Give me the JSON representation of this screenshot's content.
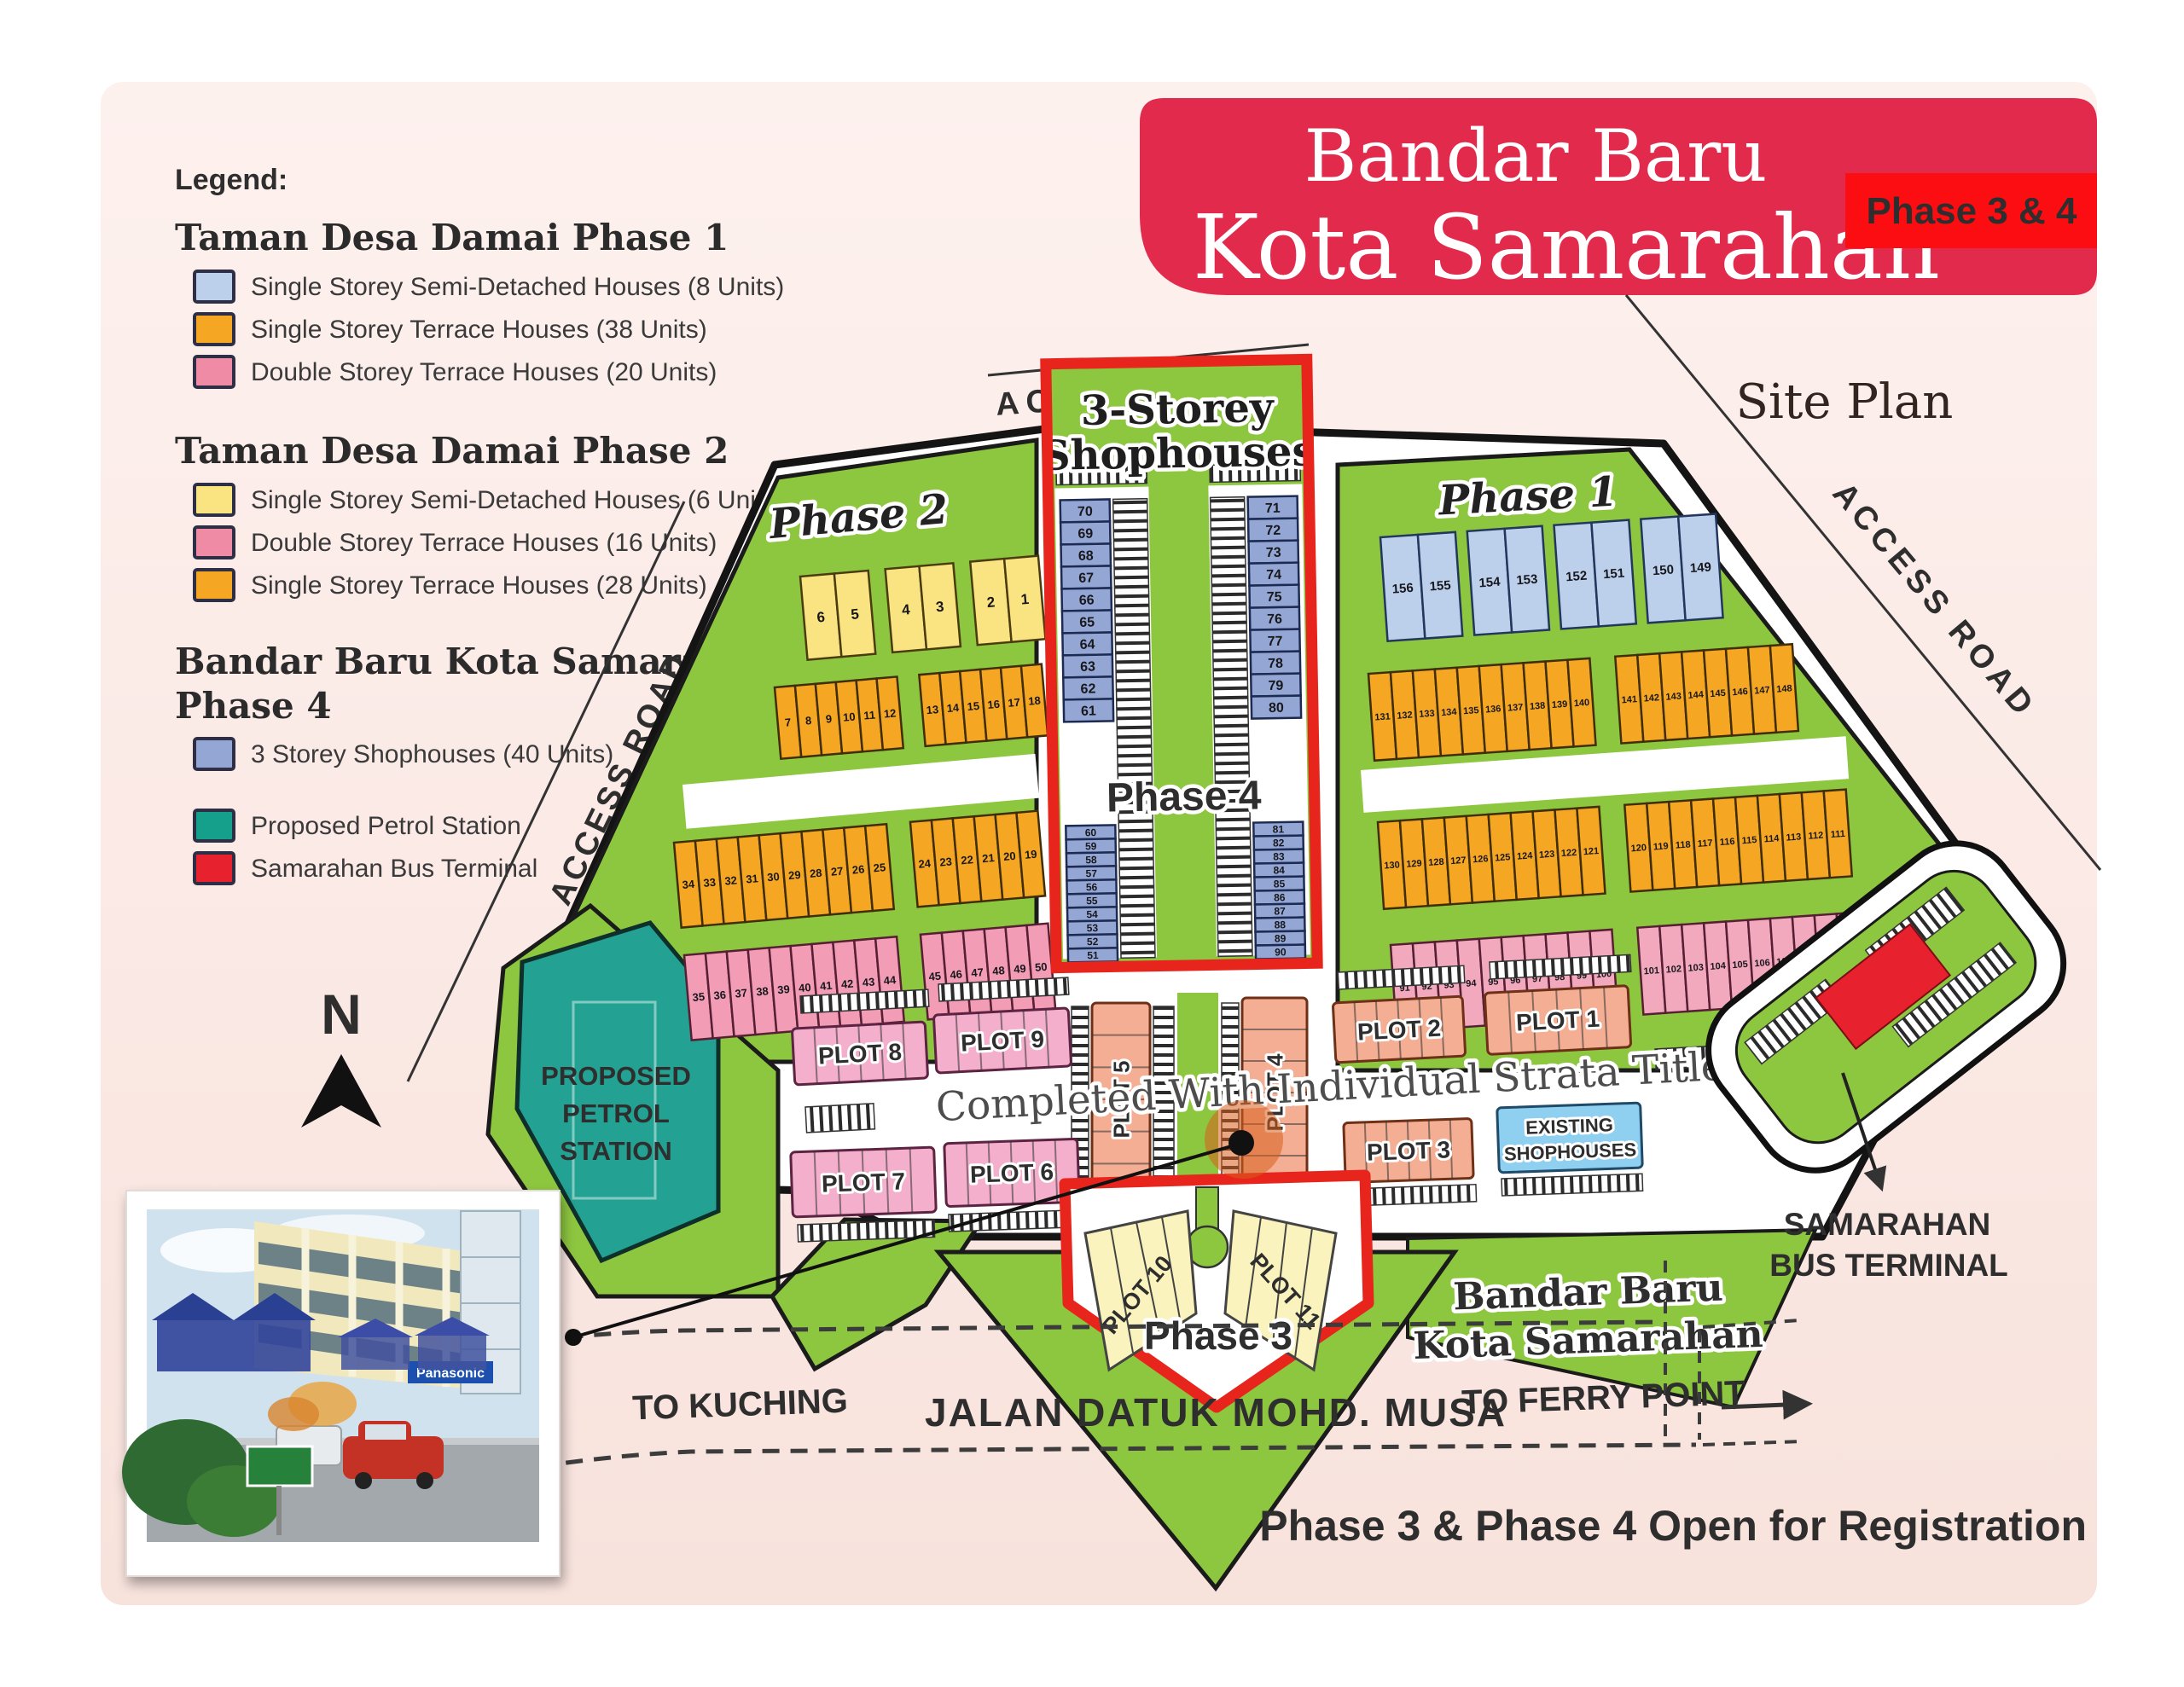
{
  "title": {
    "line1": "Bandar Baru",
    "line2": "Kota Samarahan",
    "badge": "Phase 3 & 4",
    "banner_color": "#e22a4c",
    "badge_color": "#fb0d12",
    "site_plan": "Site Plan"
  },
  "legend": {
    "heading": "Legend:",
    "sections": [
      {
        "title": "Taman Desa Damai Phase 1",
        "items": [
          {
            "color": "#BCD0EC",
            "label": "Single Storey Semi-Detached Houses (8 Units)"
          },
          {
            "color": "#F5A623",
            "label": "Single Storey Terrace Houses (38 Units)"
          },
          {
            "color": "#F08BA6",
            "label": "Double Storey Terrace Houses (20 Units)"
          }
        ]
      },
      {
        "title": "Taman Desa Damai Phase 2",
        "items": [
          {
            "color": "#FAE482",
            "label": "Single Storey Semi-Detached Houses (6 Units)"
          },
          {
            "color": "#F08BA6",
            "label": "Double Storey Terrace Houses (16 Units)"
          },
          {
            "color": "#F5A623",
            "label": "Single Storey Terrace Houses (28 Units)"
          }
        ]
      },
      {
        "title": "Bandar Baru Kota Samarahan",
        "title2": "Phase 4",
        "items": [
          {
            "color": "#93A6D4",
            "label": "3 Storey Shophouses (40 Units)"
          }
        ]
      }
    ],
    "extras": [
      {
        "color": "#14A08A",
        "label": "Proposed Petrol Station"
      },
      {
        "color": "#E8212E",
        "label": "Samarahan Bus Terminal"
      }
    ]
  },
  "map": {
    "labels": {
      "access_road": "ACCESS ROAD",
      "phase1": "Phase 1",
      "phase2": "Phase 2",
      "phase3": "Phase 3",
      "phase4": "Phase 4",
      "shophouses_l1": "3-Storey",
      "shophouses_l2": "Shophouses",
      "strata": "Completed With Individual Strata Title",
      "petrol_l1": "PROPOSED",
      "petrol_l2": "PETROL",
      "petrol_l3": "STATION",
      "terminal_l1": "SAMARAHAN",
      "terminal_l2": "BUS TERMINAL",
      "bandar_l1": "Bandar Baru",
      "bandar_l2": "Kota Samarahan",
      "jalan": "JALAN DATUK MOHD. MUSA",
      "kuching": "TO KUCHING",
      "ferry": "TO FERRY POINT",
      "compass": "N"
    },
    "plots": {
      "p1": "PLOT 1",
      "p2": "PLOT 2",
      "p3": "PLOT 3",
      "p4": "PLOT 4",
      "p5": "PLOT 5",
      "p6": "PLOT 6",
      "p7": "PLOT 7",
      "p8": "PLOT 8",
      "p9": "PLOT 9",
      "p10": "PLOT 10",
      "p11": "PLOT 11",
      "existing_l1": "EXISTING",
      "existing_l2": "SHOPHOUSES"
    },
    "lots": {
      "p2_yellow": [
        6,
        5,
        4,
        3,
        2,
        1
      ],
      "p2_orange1": [
        7,
        8,
        9,
        10,
        11,
        12,
        13,
        14,
        15,
        16,
        17,
        18
      ],
      "p2_orange2": [
        34,
        33,
        32,
        31,
        30,
        29,
        28,
        27,
        26,
        25,
        24,
        23,
        22,
        21,
        20,
        19
      ],
      "p2_pink": [
        35,
        36,
        37,
        38,
        39,
        40,
        41,
        42,
        43,
        44,
        45,
        46,
        47,
        48,
        49,
        50
      ],
      "p4_col1": [
        70,
        69,
        68,
        67,
        66,
        65,
        64,
        63,
        62,
        61
      ],
      "p4_col2": [
        71,
        72,
        73,
        74,
        75,
        76,
        77,
        78,
        79,
        80
      ],
      "p4_col3": [
        60,
        59,
        58,
        57,
        56,
        55,
        54,
        53,
        52,
        51
      ],
      "p4_col4": [
        81,
        82,
        83,
        84,
        85,
        86,
        87,
        88,
        89,
        90
      ],
      "p1_blue": [
        156,
        155,
        154,
        153,
        152,
        151,
        150,
        149
      ],
      "p1_orange1": [
        131,
        132,
        133,
        134,
        135,
        136,
        137,
        138,
        139,
        140,
        141,
        142,
        143,
        144,
        145,
        146,
        147,
        148
      ],
      "p1_orange2": [
        130,
        129,
        128,
        127,
        126,
        125,
        124,
        123,
        122,
        121,
        120,
        119,
        118,
        117,
        116,
        115,
        114,
        113,
        112,
        111
      ],
      "p1_pink": [
        91,
        92,
        93,
        94,
        95,
        96,
        97,
        98,
        99,
        100,
        101,
        102,
        103,
        104,
        105,
        106,
        107,
        108,
        109,
        110
      ]
    }
  },
  "photo": {
    "sign": "Panasonic"
  },
  "footer": {
    "text": "Phase 3  & Phase 4 Open for Registration",
    "color": "#fe0000"
  }
}
